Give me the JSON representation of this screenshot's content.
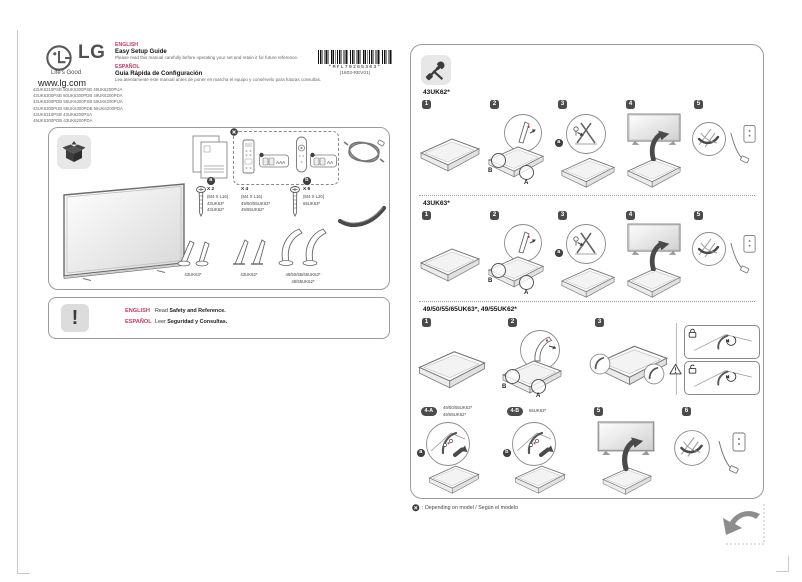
{
  "colors": {
    "accent": "#c13a60",
    "badge": "#4a4b4d"
  },
  "header": {
    "brand": "LG",
    "tagline": "Life's Good",
    "website": "www.lg.com",
    "en": {
      "lang": "ENGLISH",
      "title": "Easy Setup Guide",
      "note": "Please read this manual carefully before operating your set and retain it for future reference."
    },
    "es": {
      "lang": "ESPAÑOL",
      "title": "Guía Rápida de Configuración",
      "note": "Lea atentamente este manual antes de poner en marcha el equipo y consérvelo para futuras consultas."
    },
    "models": [
      "43UK6310PSB 50UK6300PSB 49UK6200PUA",
      "43UK6300PSB 50UK6300PDB 49UK6200PDA",
      "43UK6300PDB 55UK6300PSB 55UK6200PUA",
      "43UK6300PUB 65UK6300PDB 55UK6200PDA",
      "43UK6310PSB 43UK6200PSA",
      "49UK6300PDB 43UK6200PDA"
    ],
    "barcode_text": "*MFL70265303*",
    "barcode_rev": "(1803-REV01)"
  },
  "accessories": {
    "screw_a": {
      "badge": "a",
      "qty": "X 2",
      "size": "(M4 X L16)",
      "model1": "43UK63*",
      "model2": "43UK62*"
    },
    "screw_mid": {
      "qty": "X 4",
      "size": "(M4 X L16)",
      "model1": "49/50/55UK63*",
      "model2": "49/55UK62*"
    },
    "screw_b": {
      "badge": "b",
      "qty": "X 6",
      "size": "(M4 X L20)",
      "model1": "65UK63*"
    },
    "battery_aaa": "AAA",
    "battery_aa": "AA",
    "stand1": "43UK63*",
    "stand2": "43UK62*",
    "stand3a": "49/50/55/65UK63*",
    "stand3b": "49/55UK62*"
  },
  "safety": {
    "en_lang": "ENGLISH",
    "en_read": "Read",
    "en_doc": "Safety and Reference.",
    "es_lang": "ESPAÑOL",
    "es_read": "Leer",
    "es_doc": "Seguridad y Consultas."
  },
  "assembly": {
    "section1_title": "43UK62*",
    "section2_title": "43UK63*",
    "section3_title": "49/50/55/65UK63*, 49/55UK62*",
    "steps": {
      "s1": "1",
      "s2": "2",
      "s3": "3",
      "s4": "4",
      "s5": "5",
      "s6": "6",
      "s4a": "4-A",
      "s4b": "4-B"
    },
    "labels": {
      "A": "A",
      "B": "B",
      "a": "a",
      "b": "b"
    },
    "s4a_model1": "49/50/55UK63*",
    "s4a_model2": "49/55UK62*",
    "s4b_model1": "65UK63*",
    "footnote": ": Depending on model / Según el modelo"
  }
}
